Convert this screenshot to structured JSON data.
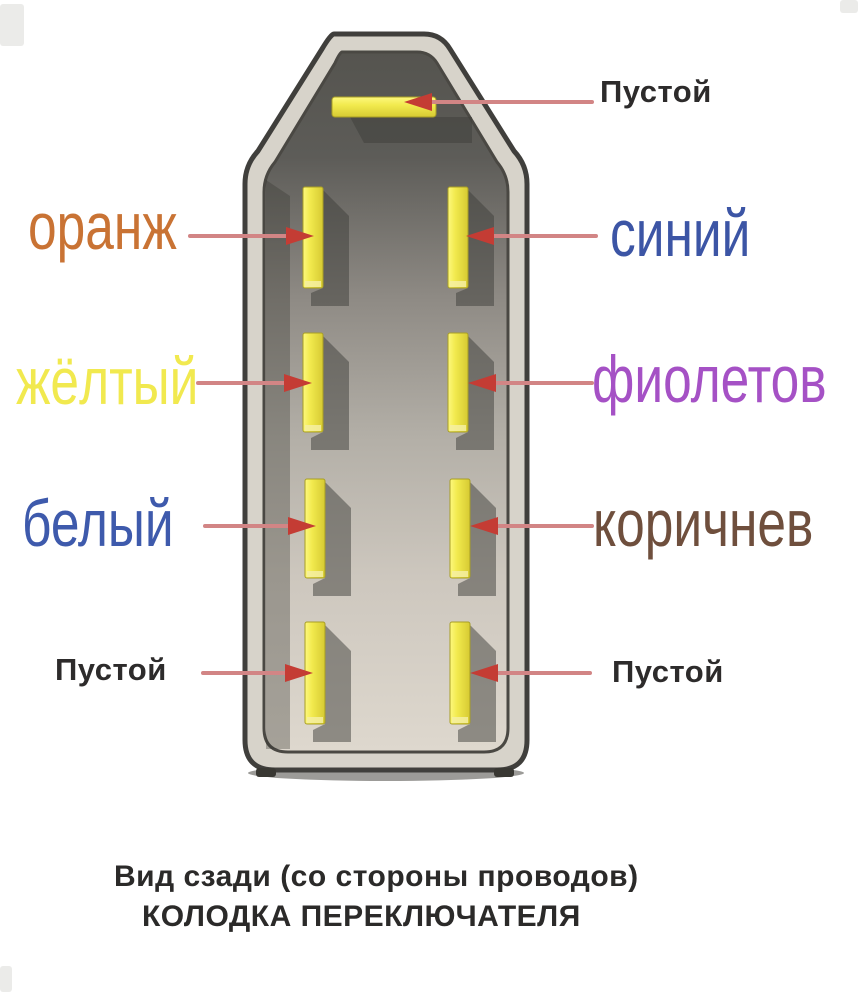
{
  "diagram_title": {
    "line1": "Вид сзади (со стороны проводов)",
    "line2": "КОЛОДКА ПЕРЕКЛЮЧАТЕЛЯ"
  },
  "labels": {
    "top_empty": {
      "text": "Пустой",
      "color": "#2d2b2b"
    },
    "orange": {
      "text": "оранж",
      "color": "#c97334"
    },
    "blue": {
      "text": "синий",
      "color": "#3c55a5"
    },
    "yellow": {
      "text": "жёлтый",
      "color": "#f1e94f"
    },
    "violet": {
      "text": "фиолетов",
      "color": "#a551c5"
    },
    "white": {
      "text": "белый",
      "color": "#3e5aac"
    },
    "brown": {
      "text": "коричнев",
      "color": "#6f4f3d"
    },
    "bottom_left_empty": {
      "text": "Пустой",
      "color": "#2d2b2b"
    },
    "bottom_right_empty": {
      "text": "Пустой",
      "color": "#2d2b2b"
    }
  },
  "pinout": [
    {
      "position": "top-center",
      "wire": "Пустой"
    },
    {
      "position": "row1-left",
      "wire": "оранж"
    },
    {
      "position": "row1-right",
      "wire": "синий"
    },
    {
      "position": "row2-left",
      "wire": "жёлтый"
    },
    {
      "position": "row2-right",
      "wire": "фиолетов"
    },
    {
      "position": "row3-left",
      "wire": "белый"
    },
    {
      "position": "row3-right",
      "wire": "коричнев"
    },
    {
      "position": "row4-left",
      "wire": "Пустой"
    },
    {
      "position": "row4-right",
      "wire": "Пустой"
    }
  ],
  "colors": {
    "connector_body": "#d7d3ca",
    "connector_outline": "#403f3c",
    "cavity_dark": "#55544f",
    "cavity_light": "#ded8ce",
    "pin": "#f2ea4e",
    "arrow_line": "#d28585",
    "arrow_head": "#c43c34",
    "caption_text": "#2b2a29"
  }
}
